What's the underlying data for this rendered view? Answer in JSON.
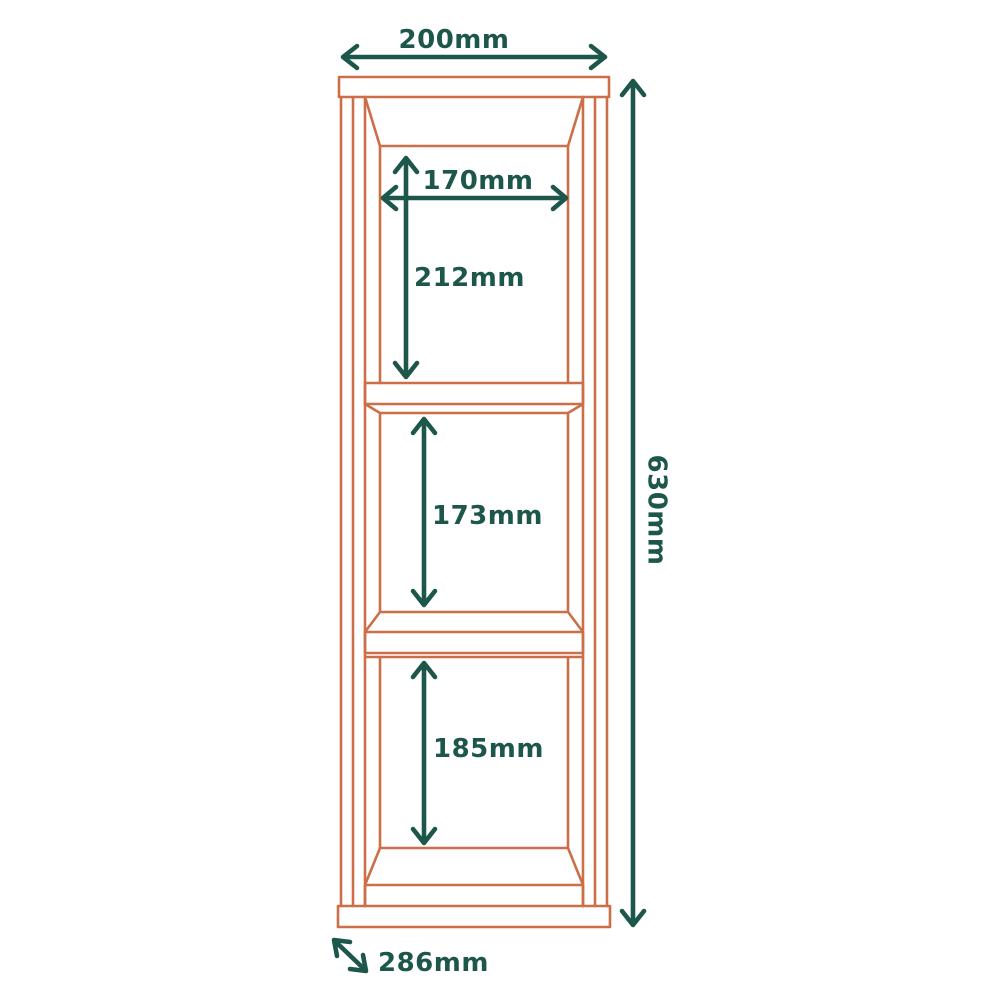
{
  "diagram": {
    "description": "Line drawing of a three-compartment shelving unit with dimension annotations",
    "unit": "mm"
  },
  "colors": {
    "furniture_outline": "#cc6f48",
    "dimension": "#1d564a",
    "background": "#ffffff"
  },
  "dimensions": {
    "top_width": {
      "label": "200mm",
      "value": 200
    },
    "inner_width": {
      "label": "170mm",
      "value": 170
    },
    "compartment_1_height": {
      "label": "212mm",
      "value": 212
    },
    "compartment_2_height": {
      "label": "173mm",
      "value": 173
    },
    "compartment_3_height": {
      "label": "185mm",
      "value": 185
    },
    "total_height": {
      "label": "630mm",
      "value": 630
    },
    "depth": {
      "label": "286mm",
      "value": 286
    }
  }
}
